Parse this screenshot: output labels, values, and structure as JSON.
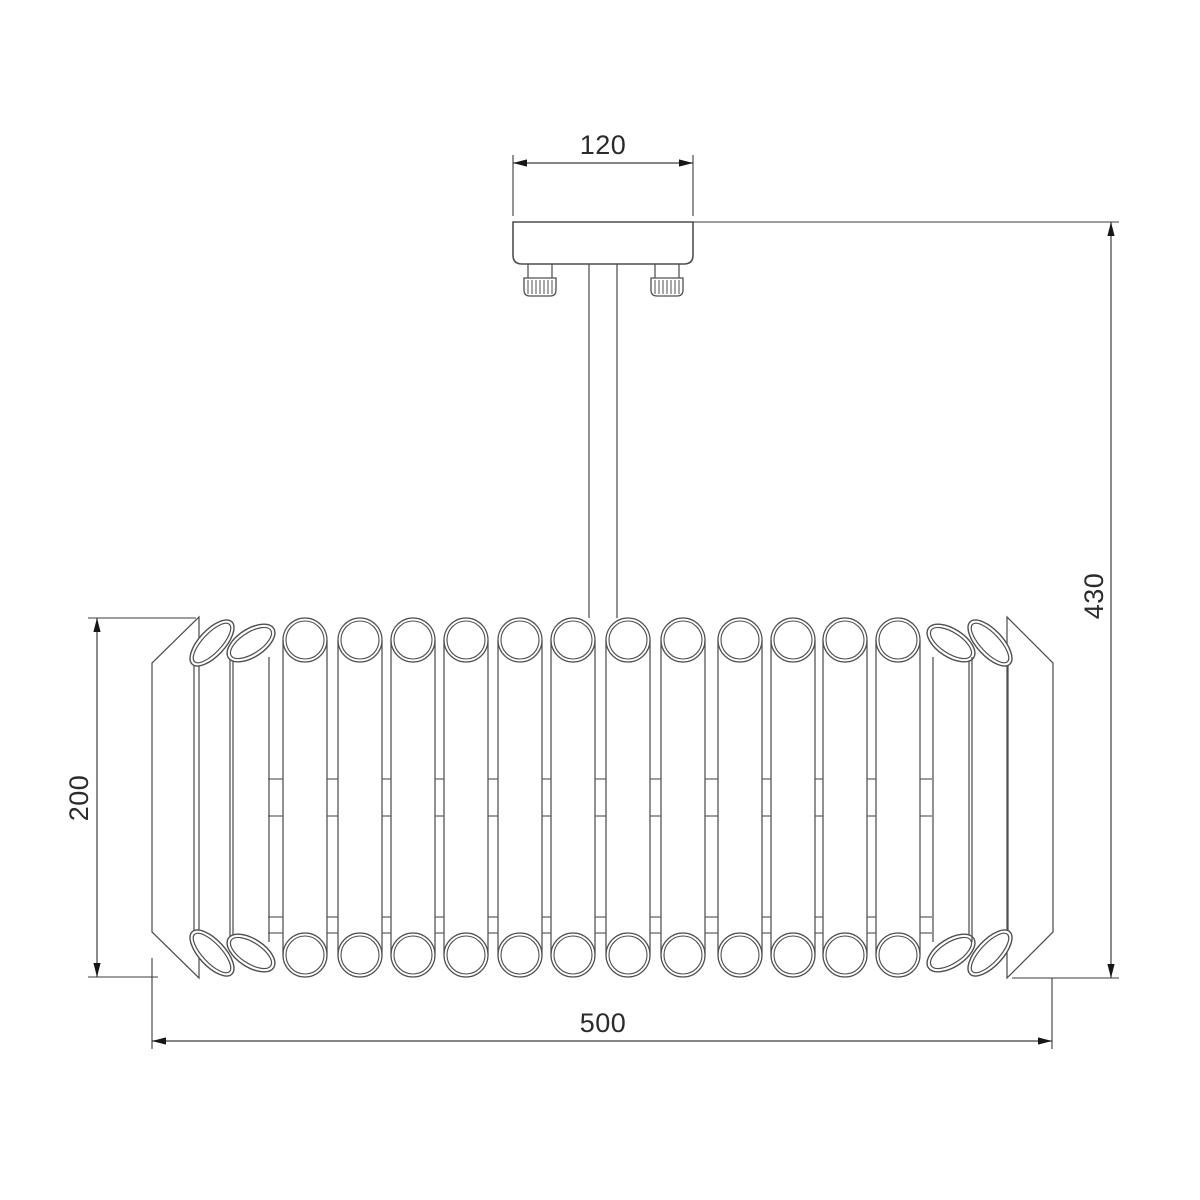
{
  "drawing": {
    "dims": {
      "mount_width": {
        "label": "120",
        "line": [
          513,
          163,
          693,
          163
        ],
        "arrows": [
          [
            513,
            163,
            "left"
          ],
          [
            693,
            163,
            "right"
          ]
        ],
        "ext": [
          [
            513,
            155,
            513,
            216
          ],
          [
            693,
            155,
            693,
            216
          ]
        ]
      },
      "shade_height": {
        "label": "200",
        "line": [
          97,
          618,
          97,
          977
        ],
        "arrows": [
          [
            97,
            618,
            "up"
          ],
          [
            97,
            977,
            "down"
          ]
        ],
        "ext": [
          [
            88,
            618,
            196,
            618
          ],
          [
            88,
            977,
            158,
            977
          ]
        ]
      },
      "total_height": {
        "label": "430",
        "line": [
          1111,
          222,
          1111,
          978
        ],
        "arrows": [
          [
            1111,
            222,
            "up"
          ],
          [
            1111,
            978,
            "down"
          ]
        ],
        "ext": [
          [
            693,
            222,
            1119,
            222
          ],
          [
            1012,
            978,
            1119,
            978
          ]
        ]
      },
      "shade_width": {
        "label": "500",
        "line": [
          152,
          1041,
          1052,
          1041
        ],
        "arrows": [
          [
            152,
            1041,
            "left"
          ],
          [
            1052,
            1041,
            "right"
          ]
        ],
        "ext": [
          [
            152,
            958,
            152,
            1049
          ],
          [
            1052,
            978,
            1052,
            1049
          ]
        ]
      }
    },
    "canopy": {
      "x": 513,
      "y": 222,
      "w": 180,
      "h": 42,
      "corner": 9
    },
    "rod": {
      "x1": 589,
      "x2": 617,
      "y1": 264,
      "y2": 618
    },
    "screws": {
      "centers": [
        540,
        667
      ],
      "neck_w": 24,
      "neck_y1": 264,
      "neck_y2": 278,
      "cap_w": 32,
      "cap_y1": 278,
      "cap_y2": 296,
      "cap_r": 6,
      "knurl": 7
    },
    "shade": {
      "top_cy": 640,
      "bottom_cy": 955,
      "tilt_top_cy": 643,
      "tilt_bottom_cy": 953,
      "r_outer": 22,
      "r_inner": 19,
      "tilt_body_y1": 657,
      "tilt_body_y2": 942,
      "rails_y": [
        779,
        816,
        917,
        933
      ],
      "panels": {
        "left": [
          [
            199,
            617
          ],
          [
            152,
            663
          ],
          [
            152,
            932
          ],
          [
            199,
            978
          ]
        ],
        "right": [
          [
            1007,
            617
          ],
          [
            1053,
            663
          ],
          [
            1053,
            932
          ],
          [
            1007,
            978
          ]
        ]
      },
      "tubes": [
        {
          "cx": 212,
          "type": "tilt",
          "rx": 29,
          "ry": 13,
          "rot": -47
        },
        {
          "cx": 251,
          "type": "tilt",
          "rx": 27,
          "ry": 14,
          "rot": -33
        },
        {
          "cx": 305,
          "type": "circle"
        },
        {
          "cx": 360,
          "type": "circle"
        },
        {
          "cx": 413,
          "type": "circle"
        },
        {
          "cx": 466,
          "type": "circle"
        },
        {
          "cx": 520,
          "type": "circle"
        },
        {
          "cx": 573,
          "type": "circle"
        },
        {
          "cx": 628,
          "type": "circle"
        },
        {
          "cx": 683,
          "type": "circle"
        },
        {
          "cx": 740,
          "type": "circle"
        },
        {
          "cx": 793,
          "type": "circle"
        },
        {
          "cx": 845,
          "type": "circle"
        },
        {
          "cx": 898,
          "type": "circle"
        },
        {
          "cx": 951,
          "type": "tilt",
          "rx": 27,
          "ry": 14,
          "rot": 33
        },
        {
          "cx": 990,
          "type": "tilt",
          "rx": 29,
          "ry": 13,
          "rot": 47
        }
      ]
    },
    "colors": {
      "line": "#4f4f4f",
      "dim_line": "#3d3d3d",
      "arrow": "#161616",
      "background": "#ffffff"
    }
  }
}
